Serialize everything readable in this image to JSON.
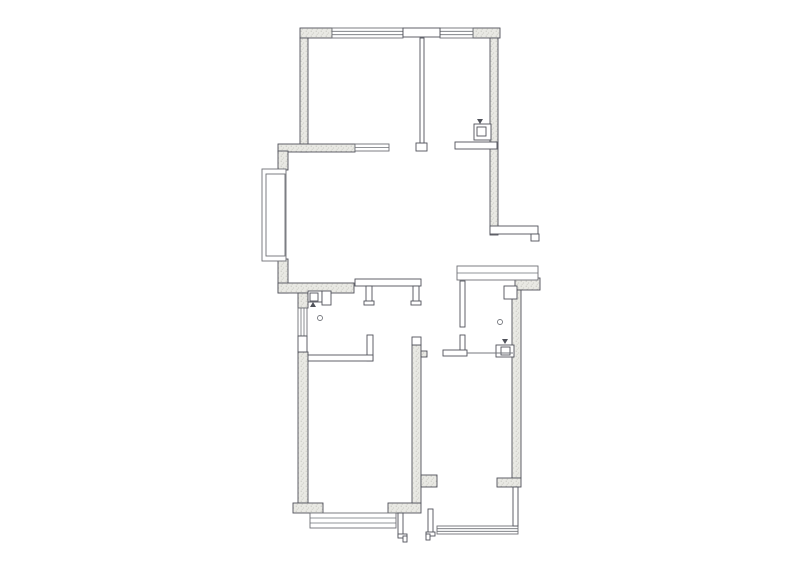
{
  "canvas": {
    "width": 800,
    "height": 570,
    "viewbox": "0 0 800 570"
  },
  "palette": {
    "paper": "#ffffff",
    "wall_fill": "#e9e9e4",
    "wall_dot": "#b9b9b2",
    "outline": "#50525a",
    "window": "#6e7076",
    "thin": "#75777d"
  },
  "floorplan": {
    "walls": [
      {
        "x": 300,
        "y": 28,
        "w": 32,
        "h": 10,
        "name": "top-wall-left"
      },
      {
        "x": 473,
        "y": 28,
        "w": 27,
        "h": 10,
        "name": "top-wall-right"
      },
      {
        "x": 300,
        "y": 38,
        "w": 8,
        "h": 114,
        "name": "upper-left-wall"
      },
      {
        "x": 490,
        "y": 38,
        "w": 8,
        "h": 197,
        "name": "upper-right-wall"
      },
      {
        "x": 278,
        "y": 144,
        "w": 77,
        "h": 8,
        "name": "mid-horizontal-wall"
      },
      {
        "x": 278,
        "y": 151,
        "w": 10,
        "h": 19,
        "name": "living-left-wall-above-bay"
      },
      {
        "x": 278,
        "y": 259,
        "w": 10,
        "h": 34,
        "name": "living-left-wall-below-bay"
      },
      {
        "x": 278,
        "y": 283,
        "w": 76,
        "h": 10,
        "name": "living-bottom-wall"
      },
      {
        "x": 298,
        "y": 293,
        "w": 10,
        "h": 15,
        "name": "bath-left-wall-top"
      },
      {
        "x": 298,
        "y": 352,
        "w": 10,
        "h": 151,
        "name": "lower-left-wall"
      },
      {
        "x": 293,
        "y": 503,
        "w": 30,
        "h": 10,
        "name": "bottom-left-corner-wall"
      },
      {
        "x": 388,
        "y": 503,
        "w": 33,
        "h": 10,
        "name": "bottom-center-wall"
      },
      {
        "x": 412,
        "y": 345,
        "w": 9,
        "h": 158,
        "name": "center-wall"
      },
      {
        "x": 421,
        "y": 351,
        "w": 6,
        "h": 6,
        "name": "center-wall-tab"
      },
      {
        "x": 421,
        "y": 475,
        "w": 16,
        "h": 12,
        "name": "center-wall-stub"
      },
      {
        "x": 515,
        "y": 278,
        "w": 25,
        "h": 12,
        "name": "right-window-corner"
      },
      {
        "x": 512,
        "y": 290,
        "w": 9,
        "h": 188,
        "name": "lower-right-wall"
      },
      {
        "x": 497,
        "y": 478,
        "w": 24,
        "h": 9,
        "name": "right-wall-stub"
      }
    ],
    "panels": [
      {
        "x": 403,
        "y": 28,
        "w": 37,
        "h": 9,
        "name": "lintel"
      },
      {
        "x": 416,
        "y": 143,
        "w": 11,
        "h": 8,
        "name": "wall-cap"
      },
      {
        "x": 420,
        "y": 38,
        "w": 4,
        "h": 105,
        "name": "partition-upper-rooms"
      },
      {
        "x": 490,
        "y": 226,
        "w": 48,
        "h": 8,
        "name": "balcony-ledge"
      },
      {
        "x": 531,
        "y": 234,
        "w": 8,
        "h": 7,
        "name": "ledge-notch"
      },
      {
        "x": 455,
        "y": 142,
        "w": 42,
        "h": 7,
        "name": "kitchen-counter"
      },
      {
        "x": 355,
        "y": 279,
        "w": 66,
        "h": 7,
        "name": "bath-top-partition"
      },
      {
        "x": 366,
        "y": 286,
        "w": 6,
        "h": 17,
        "name": "bath-hanging-wall"
      },
      {
        "x": 364,
        "y": 301,
        "w": 10,
        "h": 4,
        "name": "wall-cap"
      },
      {
        "x": 413,
        "y": 286,
        "w": 6,
        "h": 17,
        "name": "hall-hanging-wall"
      },
      {
        "x": 411,
        "y": 301,
        "w": 10,
        "h": 4,
        "name": "wall-cap"
      },
      {
        "x": 367,
        "y": 335,
        "w": 6,
        "h": 26,
        "name": "bath-partition-riser"
      },
      {
        "x": 308,
        "y": 355,
        "w": 65,
        "h": 6,
        "name": "bath-bottom-partition"
      },
      {
        "x": 412,
        "y": 337,
        "w": 9,
        "h": 8,
        "name": "wall-cap"
      },
      {
        "x": 298,
        "y": 336,
        "w": 9,
        "h": 16,
        "name": "wall-opening-panel"
      },
      {
        "x": 460,
        "y": 281,
        "w": 5,
        "h": 46,
        "name": "bedroom-left-wall-upper"
      },
      {
        "x": 460,
        "y": 335,
        "w": 5,
        "h": 17,
        "name": "bedroom-left-wall-lower"
      },
      {
        "x": 443,
        "y": 350,
        "w": 24,
        "h": 6,
        "name": "bedroom-counter-block"
      },
      {
        "x": 504,
        "y": 286,
        "w": 13,
        "h": 13,
        "name": "column"
      },
      {
        "x": 513,
        "y": 487,
        "w": 5,
        "h": 39,
        "name": "right-thin-wall"
      },
      {
        "x": 398,
        "y": 513,
        "w": 5,
        "h": 24,
        "name": "door-jamb-left"
      },
      {
        "x": 398,
        "y": 534,
        "w": 9,
        "h": 4,
        "name": "door-stop"
      },
      {
        "x": 403,
        "y": 536,
        "w": 4,
        "h": 6,
        "name": "door-stop"
      },
      {
        "x": 428,
        "y": 509,
        "w": 5,
        "h": 26,
        "name": "door-jamb-right"
      },
      {
        "x": 426,
        "y": 532,
        "w": 9,
        "h": 4,
        "name": "door-stop"
      },
      {
        "x": 426,
        "y": 534,
        "w": 4,
        "h": 6,
        "name": "door-stop"
      },
      {
        "x": 474,
        "y": 124,
        "w": 17,
        "h": 16,
        "name": "appliance-body"
      },
      {
        "x": 477,
        "y": 127,
        "w": 9,
        "h": 9,
        "name": "appliance-inner"
      },
      {
        "x": 308,
        "y": 291,
        "w": 14,
        "h": 11,
        "name": "sink-body"
      },
      {
        "x": 310,
        "y": 293,
        "w": 8,
        "h": 8,
        "name": "sink-basin"
      },
      {
        "x": 322,
        "y": 291,
        "w": 9,
        "h": 14,
        "name": "cabinet-box"
      },
      {
        "x": 496,
        "y": 345,
        "w": 18,
        "h": 12,
        "name": "appliance-body"
      },
      {
        "x": 501,
        "y": 347,
        "w": 9,
        "h": 8,
        "name": "appliance-inner"
      }
    ],
    "windows": [
      {
        "x": 332,
        "y": 28,
        "w": 71,
        "h": 10,
        "dir": "h",
        "n": 2,
        "name": "top-window-left"
      },
      {
        "x": 440,
        "y": 28,
        "w": 33,
        "h": 10,
        "dir": "h",
        "n": 2,
        "name": "top-window-right"
      },
      {
        "x": 355,
        "y": 144,
        "w": 34,
        "h": 7,
        "dir": "h",
        "n": 1,
        "name": "mid-window"
      },
      {
        "x": 262,
        "y": 169,
        "w": 24,
        "h": 92,
        "dir": "h",
        "n": 0,
        "name": "bay-window-outer"
      },
      {
        "x": 266,
        "y": 174,
        "w": 19,
        "h": 82,
        "dir": "h",
        "n": 0,
        "name": "bay-window-inner"
      },
      {
        "x": 298,
        "y": 308,
        "w": 9,
        "h": 28,
        "dir": "v",
        "n": 2,
        "name": "bath-side-window"
      },
      {
        "x": 457,
        "y": 266,
        "w": 81,
        "h": 14,
        "dir": "h",
        "n": 1,
        "name": "bedroom-top-window"
      },
      {
        "x": 310,
        "y": 513,
        "w": 86,
        "h": 15,
        "dir": "h",
        "n": 2,
        "name": "bottom-bay-window"
      },
      {
        "x": 437,
        "y": 526,
        "w": 81,
        "h": 8,
        "dir": "h",
        "n": 2,
        "name": "bottom-right-window"
      }
    ],
    "lines": [
      {
        "x1": 467,
        "y1": 353,
        "x2": 513,
        "y2": 353,
        "name": "counter-line"
      }
    ],
    "circles": [
      {
        "cx": 320,
        "cy": 318,
        "r": 2.5,
        "name": "drain-symbol"
      },
      {
        "cx": 500,
        "cy": 322,
        "r": 2.5,
        "name": "drain-symbol"
      }
    ],
    "markers": [
      {
        "cx": 480,
        "cy": 121,
        "dir": "down",
        "name": "valve-marker"
      },
      {
        "cx": 313,
        "cy": 305,
        "dir": "up",
        "name": "valve-marker"
      },
      {
        "cx": 505,
        "cy": 341,
        "dir": "down",
        "name": "valve-marker"
      }
    ]
  }
}
